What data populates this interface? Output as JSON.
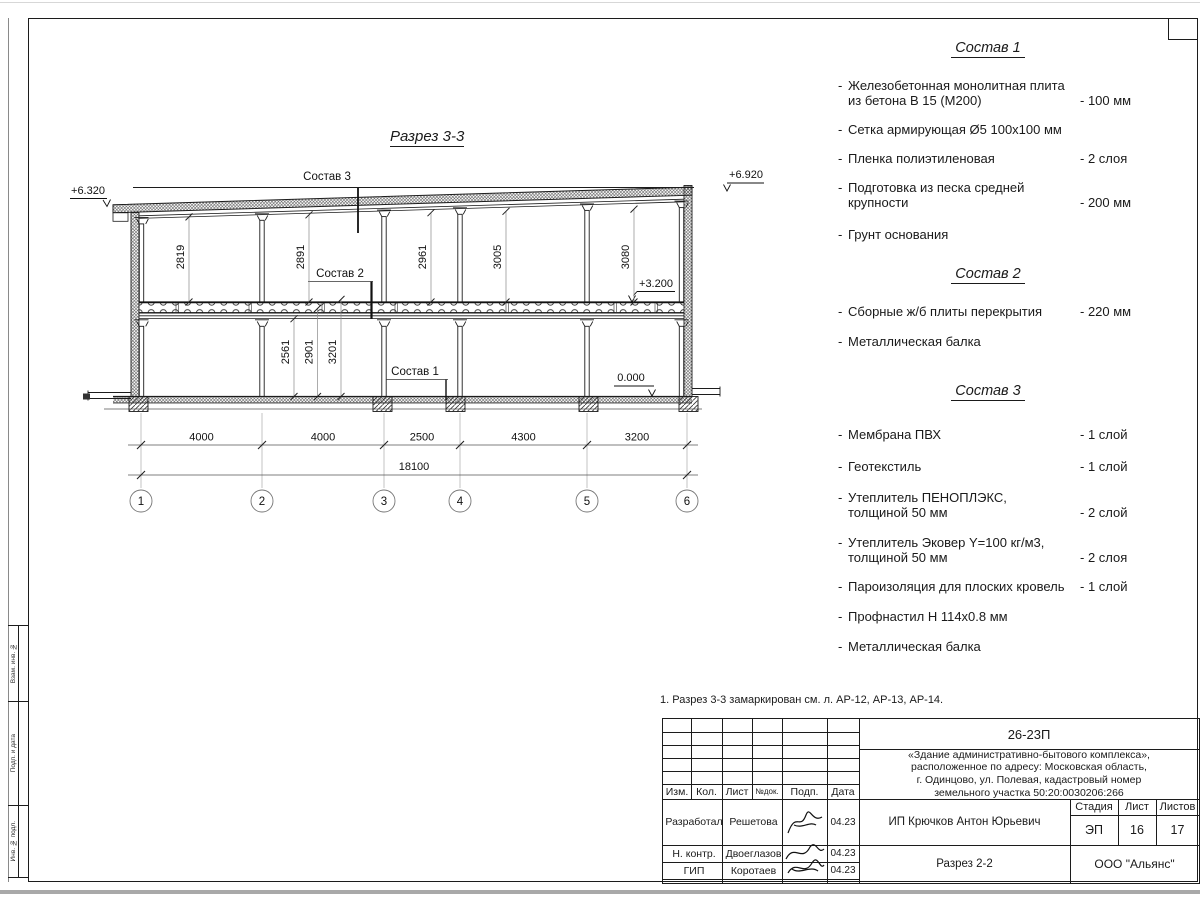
{
  "drawing": {
    "title": "Разрез 3-3",
    "elevations": {
      "left": "+6.320",
      "right": "+6.920",
      "floor": "+3.200",
      "ground": "0.000"
    },
    "callouts": {
      "c1": "Состав 1",
      "c2": "Состав 2",
      "c3": "Состав 3"
    },
    "dims_upper": [
      "2819",
      "2891",
      "2961",
      "3005",
      "3080"
    ],
    "dims_lower": [
      "2561",
      "2901",
      "3201"
    ],
    "dims_bottom": [
      "4000",
      "4000",
      "2500",
      "4300",
      "3200"
    ],
    "dim_total": "18100",
    "axes": [
      "1",
      "2",
      "3",
      "4",
      "5",
      "6"
    ]
  },
  "specs": {
    "dash": "-",
    "s1": {
      "title": "Состав 1",
      "items": [
        {
          "text": "Железобетонная  монолитная плита\nиз бетона В 15 (М200)",
          "value": "- 100 мм"
        },
        {
          "text": "Сетка армирующая Ø5 100х100 мм",
          "value": ""
        },
        {
          "text": "Пленка полиэтиленовая",
          "value": "-  2 слоя"
        },
        {
          "text": "Подготовка из песка средней\nкрупности",
          "value": "- 200 мм"
        },
        {
          "text": "Грунт основания",
          "value": ""
        }
      ]
    },
    "s2": {
      "title": "Состав 2",
      "items": [
        {
          "text": "Сборные ж/б плиты перекрытия",
          "value": "- 220 мм"
        },
        {
          "text": "Металлическая балка",
          "value": ""
        }
      ]
    },
    "s3": {
      "title": "Состав 3",
      "items": [
        {
          "text": "Мембрана ПВХ",
          "value": "- 1 слой"
        },
        {
          "text": "Геотекстиль",
          "value": "- 1 слой"
        },
        {
          "text": "Утеплитель ПЕНОПЛЭКС,\nтолщиной 50 мм",
          "value": "- 2 слой"
        },
        {
          "text": "Утеплитель Эковер Y=100 кг/м3,\nтолщиной 50 мм",
          "value": "- 2 слоя"
        },
        {
          "text": "Пароизоляция для плоских кровель",
          "value": "- 1 слой"
        },
        {
          "text": "Профнастил Н 114х0.8 мм",
          "value": ""
        },
        {
          "text": "Металлическая балка",
          "value": ""
        }
      ]
    }
  },
  "note": "1. Разрез 3-3 замаркирован см. л. АР-12, АР-13, АР-14.",
  "titleblock": {
    "code": "26-23П",
    "project": "«Здание административно-бытового комплекса»,\nрасположенное по адресу: Московская область,\nг. Одинцово, ул. Полевая, кадастровый номер\nземельного участка 50:20:0030206:266",
    "client": "ИП Крючков Антон Юрьевич",
    "doc_name": "Разрез 2-2",
    "company": "ООО \"Альянс\"",
    "headers": {
      "izm": "Изм.",
      "kol": "Кол.",
      "list": "Лист",
      "doc": "№док.",
      "podp": "Подп.",
      "data": "Дата",
      "stage": "Стадия",
      "sheet": "Лист",
      "sheets": "Листов"
    },
    "stage": "ЭП",
    "sheet": "16",
    "sheets": "17",
    "rows": [
      {
        "role": "Разработал",
        "name": "Решетова",
        "date": "04.23"
      },
      {
        "role": "Н. контр.",
        "name": "Двоеглазов",
        "date": "04.23"
      },
      {
        "role": "ГИП",
        "name": "Коротаев",
        "date": "04.23"
      }
    ]
  },
  "side_strip": {
    "cells": [
      "Взам. инв. №",
      "Подп. и дата",
      "Инв. № подл."
    ]
  }
}
